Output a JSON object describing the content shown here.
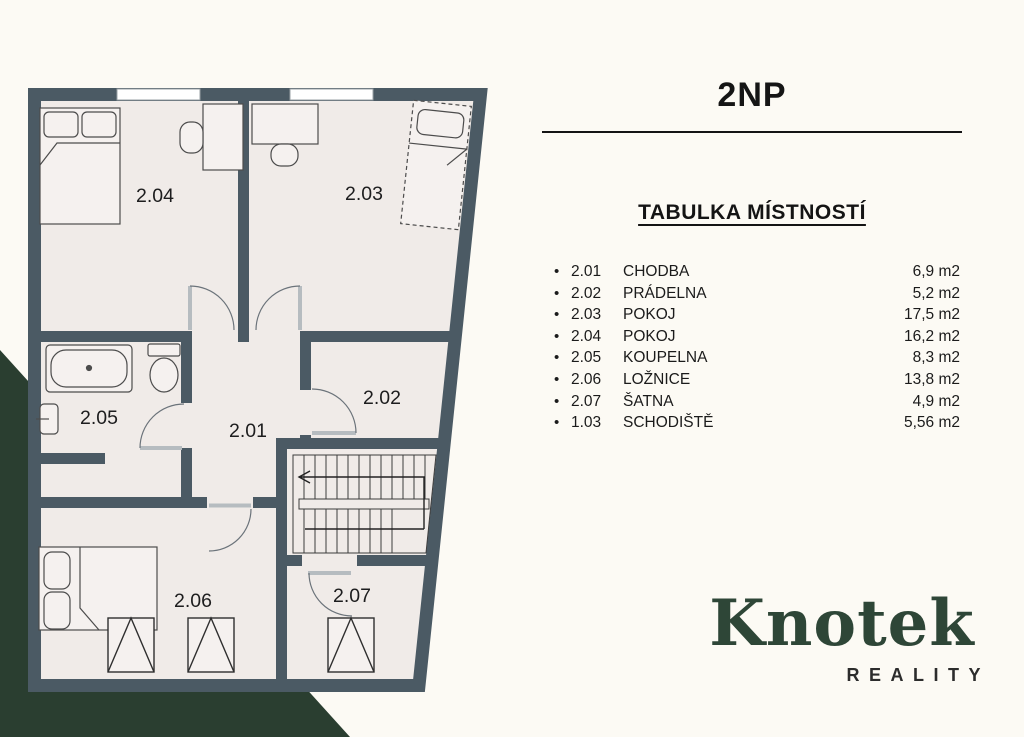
{
  "header": {
    "title": "2NP"
  },
  "room_table": {
    "heading": "TABULKA MÍSTNOSTÍ",
    "rows": [
      {
        "number": "2.01",
        "name": "CHODBA",
        "area": "6,9 m2"
      },
      {
        "number": "2.02",
        "name": "PRÁDELNA",
        "area": "5,2 m2"
      },
      {
        "number": "2.03",
        "name": "POKOJ",
        "area": "17,5 m2"
      },
      {
        "number": "2.04",
        "name": "POKOJ",
        "area": "16,2 m2"
      },
      {
        "number": "2.05",
        "name": "KOUPELNA",
        "area": "8,3 m2"
      },
      {
        "number": "2.06",
        "name": "LOŽNICE",
        "area": "13,8 m2"
      },
      {
        "number": "2.07",
        "name": "ŠATNA",
        "area": "4,9 m2"
      },
      {
        "number": "1.03",
        "name": "SCHODIŠTĚ",
        "area": "5,56 m2"
      }
    ]
  },
  "floorplan": {
    "rooms": {
      "r201": "2.01",
      "r202": "2.02",
      "r203": "2.03",
      "r204": "2.04",
      "r205": "2.05",
      "r206": "2.06",
      "r207": "2.07"
    }
  },
  "logo": {
    "brand": "Knotek",
    "subtitle": "REALITY"
  },
  "colors": {
    "wall": "#4b5a64",
    "floor": "#f0ebe8",
    "accent_green": "#2a3e30",
    "logo_green": "#2e4637",
    "background": "#fcfaf4",
    "text": "#1c1c1c"
  }
}
